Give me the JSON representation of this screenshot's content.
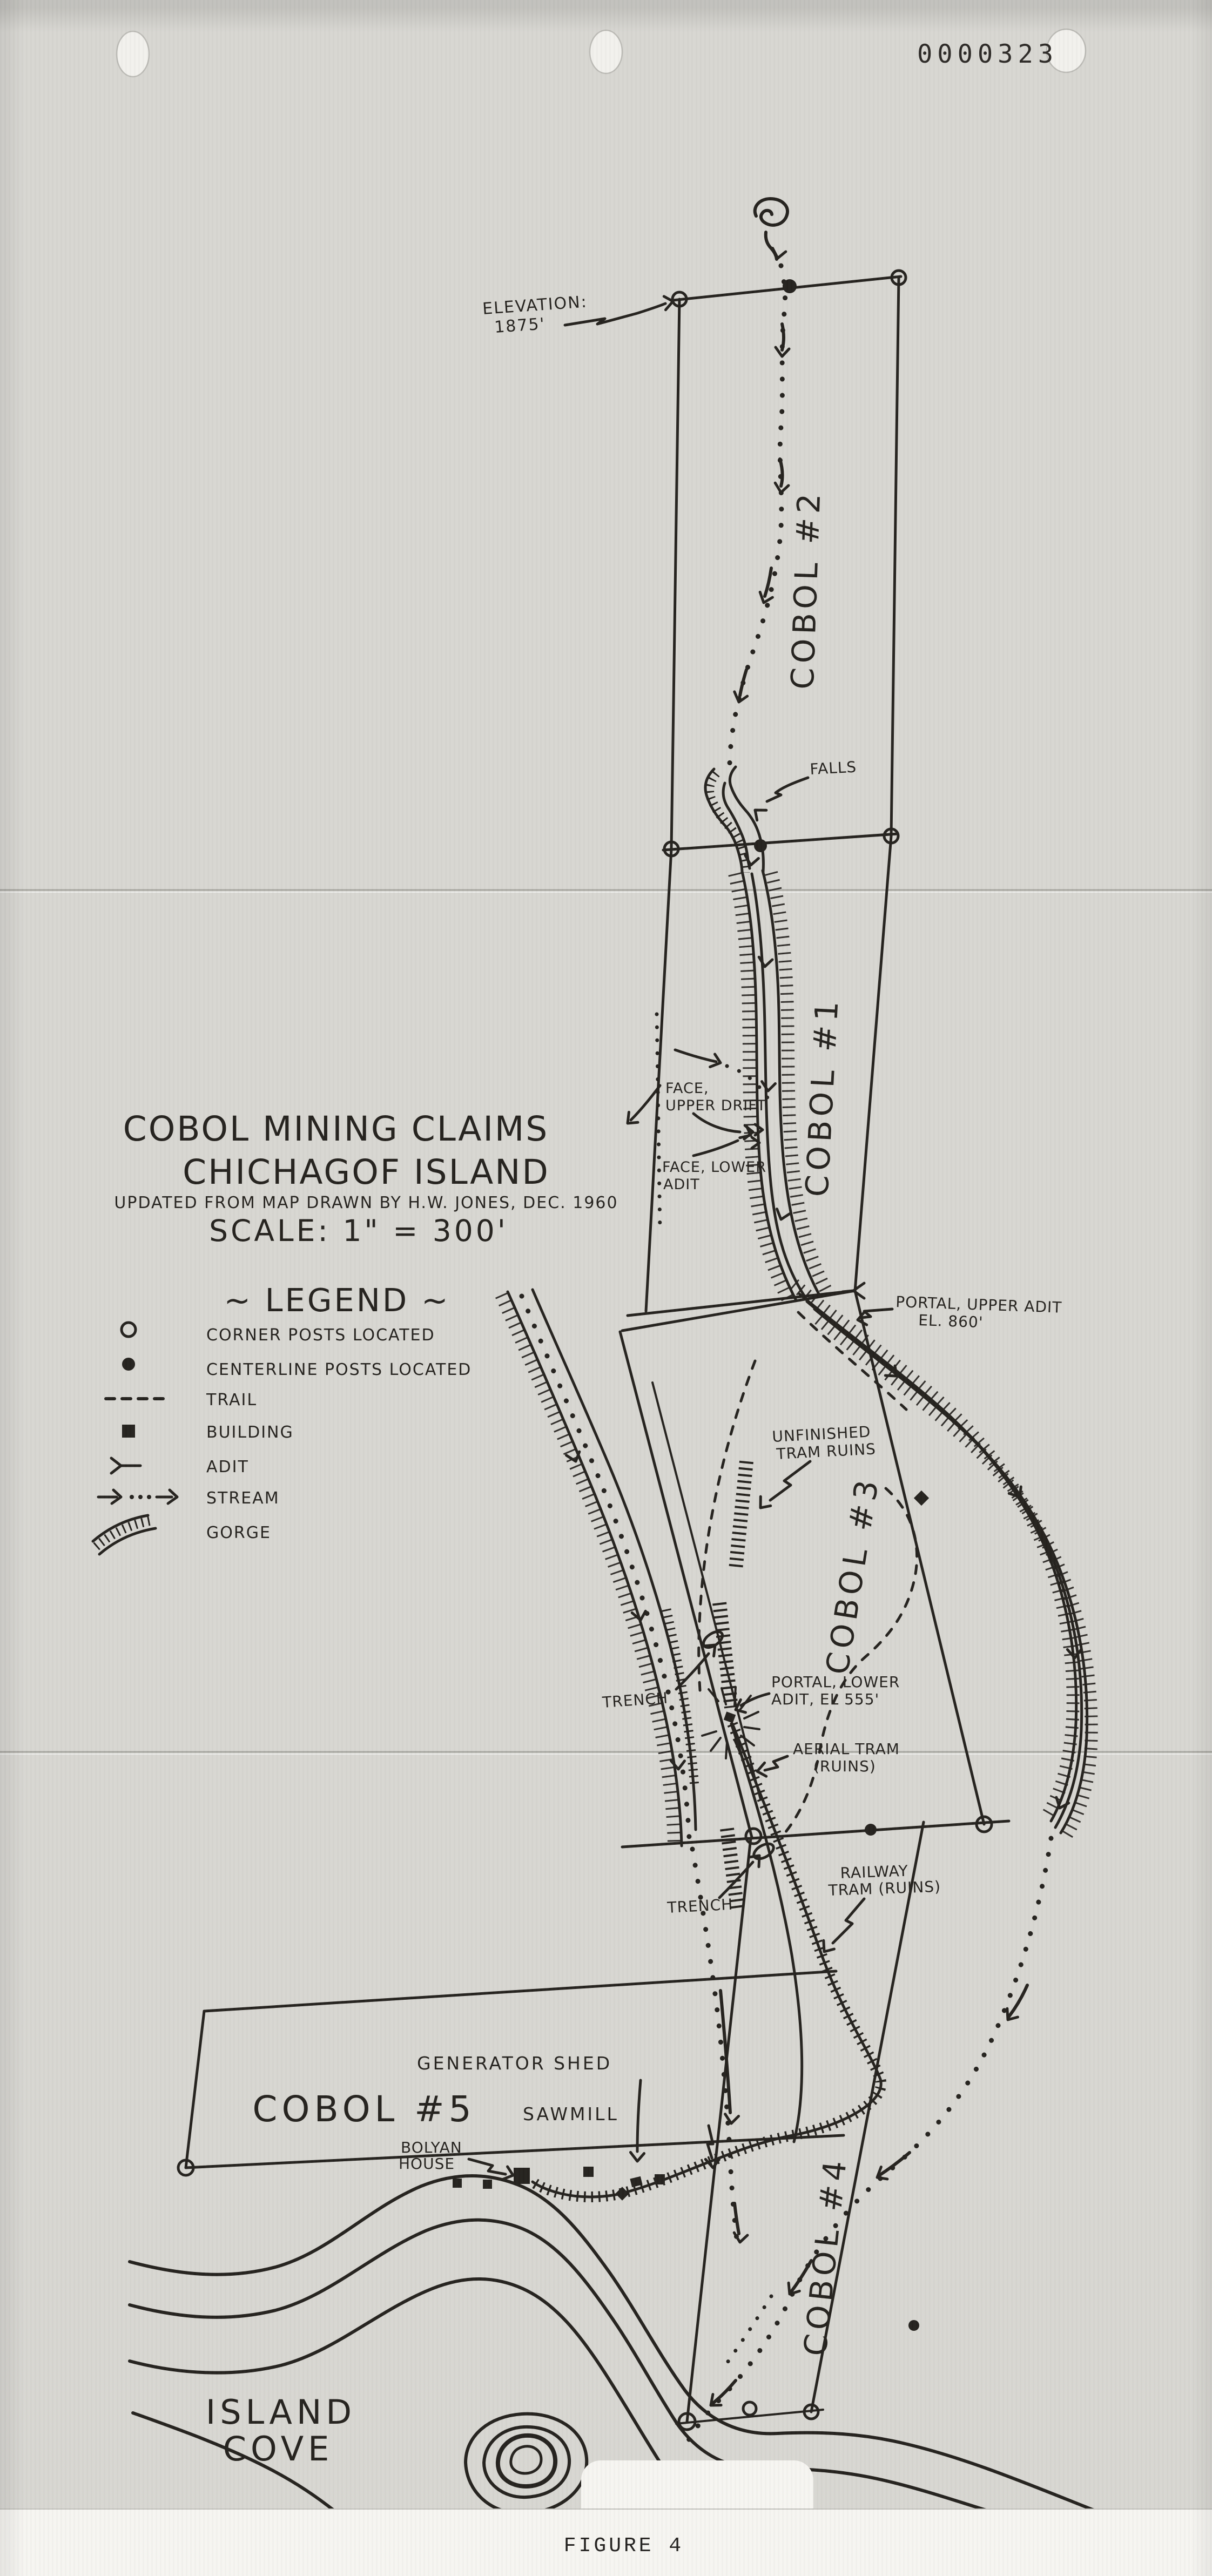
{
  "document": {
    "stamp_number": "0000323",
    "figure_caption": "FIGURE 4"
  },
  "title_block": {
    "title_line1": "COBOL MINING CLAIMS",
    "title_line2": "CHICHAGOF ISLAND",
    "subtitle": "UPDATED FROM MAP DRAWN BY H.W. JONES, DEC. 1960",
    "scale": "SCALE: 1\" = 300'"
  },
  "legend": {
    "heading": "~ LEGEND ~",
    "items": [
      {
        "symbol": "corner-post-icon",
        "label": "CORNER POSTS LOCATED"
      },
      {
        "symbol": "centerline-post-icon",
        "label": "CENTERLINE POSTS LOCATED"
      },
      {
        "symbol": "trail-icon",
        "label": "TRAIL"
      },
      {
        "symbol": "building-icon",
        "label": "BUILDING"
      },
      {
        "symbol": "adit-icon",
        "label": "ADIT"
      },
      {
        "symbol": "stream-icon",
        "label": "STREAM"
      },
      {
        "symbol": "gorge-icon",
        "label": "GORGE"
      }
    ]
  },
  "claims": {
    "cobol1": "COBOL #1",
    "cobol2": "COBOL #2",
    "cobol3": "COBOL #3",
    "cobol4": "COBOL #4",
    "cobol5": "COBOL #5"
  },
  "features": {
    "elevation_line1": "ELEVATION:",
    "elevation_line2": "1875'",
    "falls": "FALLS",
    "face_upper_line1": "FACE,",
    "face_upper_line2": "UPPER DRIFT",
    "face_lower_line1": "FACE, LOWER",
    "face_lower_line2": "ADIT",
    "portal_upper_line1": "PORTAL, UPPER ADIT",
    "portal_upper_line2": "EL. 860'",
    "unfinished_tram_line1": "UNFINISHED",
    "unfinished_tram_line2": "TRAM RUINS",
    "trench_upper": "TRENCH",
    "portal_lower_line1": "PORTAL, LOWER",
    "portal_lower_line2": "ADIT, EL 555'",
    "aerial_tram_line1": "AERIAL TRAM",
    "aerial_tram_line2": "(RUINS)",
    "railway_tram_line1": "RAILWAY",
    "railway_tram_line2": "TRAM (RUINS)",
    "trench_lower": "TRENCH",
    "generator_shed": "GENERATOR SHED",
    "sawmill": "SAWMILL",
    "bolyan_house_line1": "BOLYAN",
    "bolyan_house_line2": "HOUSE",
    "island_cove_line1": "ISLAND",
    "island_cove_line2": "COVE"
  },
  "colors": {
    "ink": "#26231f",
    "paper": "#d8d7d2",
    "caption_band": "#f6f5f1"
  }
}
